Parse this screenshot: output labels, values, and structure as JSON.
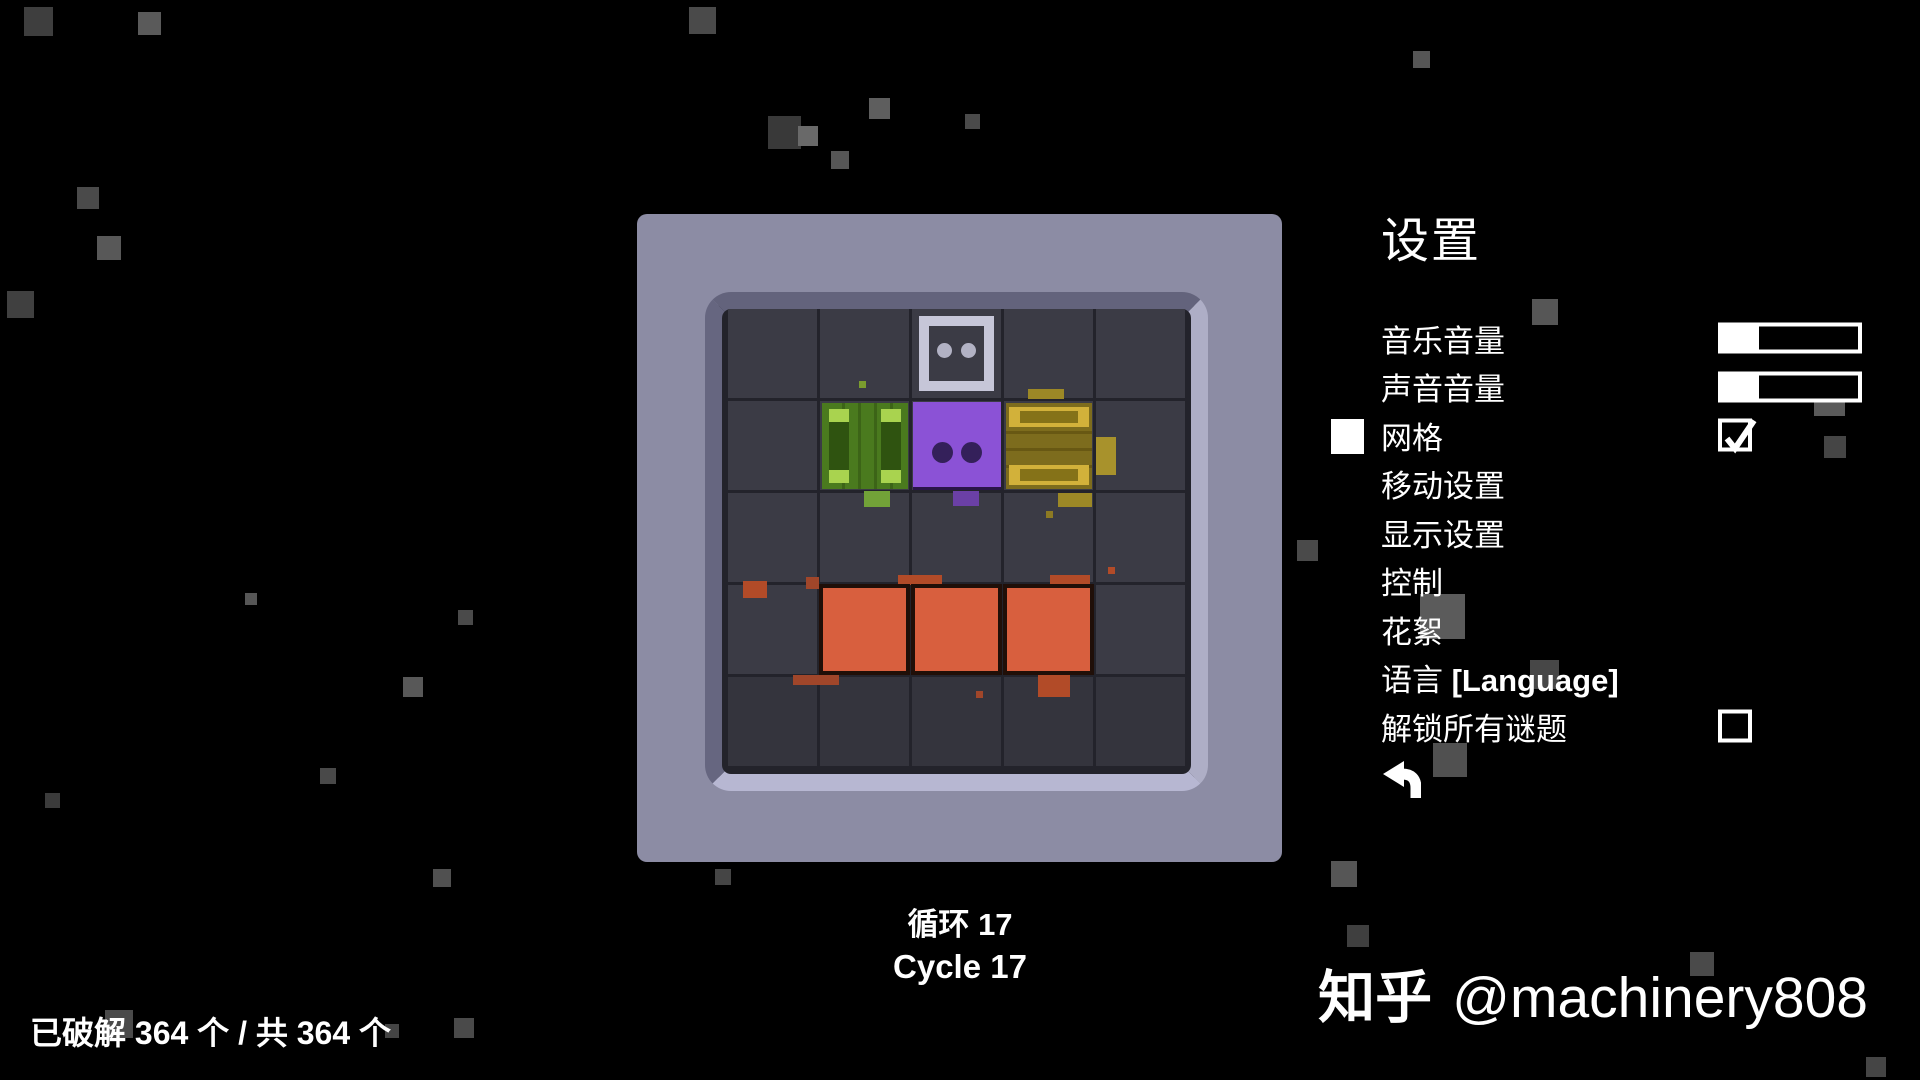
{
  "background": {
    "color": "#000000",
    "particles": [
      [
        24,
        7,
        29,
        "#3e3e3e"
      ],
      [
        138,
        12,
        23,
        "#5a5a5a"
      ],
      [
        689,
        7,
        27,
        "#4a4a4a"
      ],
      [
        768,
        116,
        33,
        "#393939"
      ],
      [
        798,
        126,
        20,
        "#696969"
      ],
      [
        831,
        151,
        18,
        "#565656"
      ],
      [
        869,
        98,
        21,
        "#5e5e5e"
      ],
      [
        965,
        114,
        15,
        "#4a4a4a"
      ],
      [
        1413,
        51,
        17,
        "#565656"
      ],
      [
        77,
        187,
        22,
        "#4a4a4a"
      ],
      [
        97,
        236,
        24,
        "#585858"
      ],
      [
        7,
        291,
        27,
        "#404040"
      ],
      [
        245,
        593,
        12,
        "#565656"
      ],
      [
        458,
        610,
        15,
        "#4a4a4a"
      ],
      [
        403,
        677,
        20,
        "#585858"
      ],
      [
        320,
        768,
        16,
        "#494949"
      ],
      [
        45,
        793,
        15,
        "#3b3b3b"
      ],
      [
        433,
        869,
        18,
        "#505050"
      ],
      [
        715,
        869,
        16,
        "#454545"
      ],
      [
        454,
        1018,
        20,
        "#4a4a4a"
      ],
      [
        1331,
        861,
        26,
        "#565656"
      ],
      [
        1532,
        299,
        26,
        "#565656"
      ],
      [
        1420,
        594,
        45,
        "#5b5b5b"
      ],
      [
        1297,
        540,
        21,
        "#4a4a4a"
      ],
      [
        1530,
        660,
        29,
        "#474747"
      ],
      [
        1433,
        743,
        34,
        "#505050"
      ],
      [
        1814,
        385,
        31,
        "#5a5a5a"
      ],
      [
        1824,
        436,
        22,
        "#454545"
      ],
      [
        1690,
        952,
        24,
        "#4a4a4a"
      ],
      [
        1866,
        1057,
        20,
        "#454545"
      ],
      [
        1347,
        925,
        22,
        "#3f3f3f"
      ],
      [
        105,
        1010,
        28,
        "#4a4a4a"
      ],
      [
        385,
        1024,
        14,
        "#444444"
      ]
    ]
  },
  "board": {
    "frame_color": "#8c8ca4",
    "well_bg": "#23232b",
    "grid": {
      "rows": 5,
      "cols": 5,
      "cell_color": "#3b3b45",
      "cell_color_bottom": "#34343d"
    },
    "colors": {
      "player": "#8b52d6",
      "player_eye": "#34205a",
      "player_edge": "#2a1548",
      "target_border": "#c6c6d8",
      "target_eye": "#b2b2c4",
      "green_body": "#4a7a1e",
      "green_line": "#3c6417",
      "green_rail": "#2f5310",
      "green_cap": "#a9d34f",
      "yellow_body": "#7d6c1d",
      "yellow_line": "#685813",
      "yellow_slat": "#857218",
      "yellow_cap": "#d2b13a",
      "orange": "#d85f3e",
      "orange_border": "#200f08"
    },
    "pieces": [
      {
        "type": "target",
        "name": "target-outline-box",
        "col": 2,
        "row": 0
      },
      {
        "type": "crate-green",
        "name": "green-crate",
        "col": 1,
        "row": 1
      },
      {
        "type": "player",
        "name": "player-box",
        "col": 2,
        "row": 1
      },
      {
        "type": "crate-yellow",
        "name": "yellow-crate",
        "col": 3,
        "row": 1
      },
      {
        "type": "orange",
        "name": "orange-block-1",
        "col": 1,
        "row": 3
      },
      {
        "type": "orange",
        "name": "orange-block-2",
        "col": 2,
        "row": 3
      },
      {
        "type": "orange",
        "name": "orange-block-3",
        "col": 3,
        "row": 3
      }
    ],
    "debris": [
      [
        131,
        72,
        7,
        7,
        "#7a9c2e"
      ],
      [
        136,
        182,
        26,
        16,
        "#72a238"
      ],
      [
        225,
        182,
        26,
        15,
        "#6b40a6"
      ],
      [
        300,
        80,
        36,
        10,
        "#9c8826"
      ],
      [
        368,
        128,
        20,
        38,
        "#a8922c"
      ],
      [
        330,
        184,
        34,
        14,
        "#9c8826"
      ],
      [
        318,
        202,
        7,
        7,
        "#8d7a23"
      ],
      [
        15,
        272,
        24,
        17,
        "#b24b28"
      ],
      [
        170,
        266,
        44,
        10,
        "#b24b28"
      ],
      [
        322,
        266,
        40,
        11,
        "#b24b28"
      ],
      [
        65,
        366,
        46,
        10,
        "#a0462a"
      ],
      [
        310,
        364,
        32,
        24,
        "#b24b28"
      ],
      [
        380,
        258,
        7,
        7,
        "#b24b28"
      ],
      [
        248,
        382,
        7,
        7,
        "#a0462a"
      ],
      [
        78,
        268,
        13,
        12,
        "#a0462a"
      ]
    ]
  },
  "settings": {
    "title": "设置",
    "selected_item": "网格",
    "items": [
      {
        "name": "music-volume",
        "label": "音乐音量",
        "control": "slider",
        "value": 0.27
      },
      {
        "name": "sound-volume",
        "label": "声音音量",
        "control": "slider",
        "value": 0.27
      },
      {
        "name": "grid",
        "label": "网格",
        "control": "checkbox",
        "checked": true,
        "selected": true
      },
      {
        "name": "movement-settings",
        "label": "移动设置"
      },
      {
        "name": "display-settings",
        "label": "显示设置"
      },
      {
        "name": "controls",
        "label": "控制"
      },
      {
        "name": "extras",
        "label": "花絮"
      },
      {
        "name": "language",
        "label": "语言",
        "label_suffix": "[Language]"
      },
      {
        "name": "unlock-all-puzzles",
        "label": "解锁所有谜题",
        "control": "checkbox",
        "checked": false
      },
      {
        "name": "back",
        "icon": "back-arrow"
      }
    ]
  },
  "hud": {
    "cycle_zh_label": "循环",
    "cycle_en_label": "Cycle",
    "cycle_value": "17",
    "solved_text": "已破解 364 个 / 共 364 个"
  },
  "watermark": {
    "brand": "知乎",
    "handle": "@machinery808"
  }
}
